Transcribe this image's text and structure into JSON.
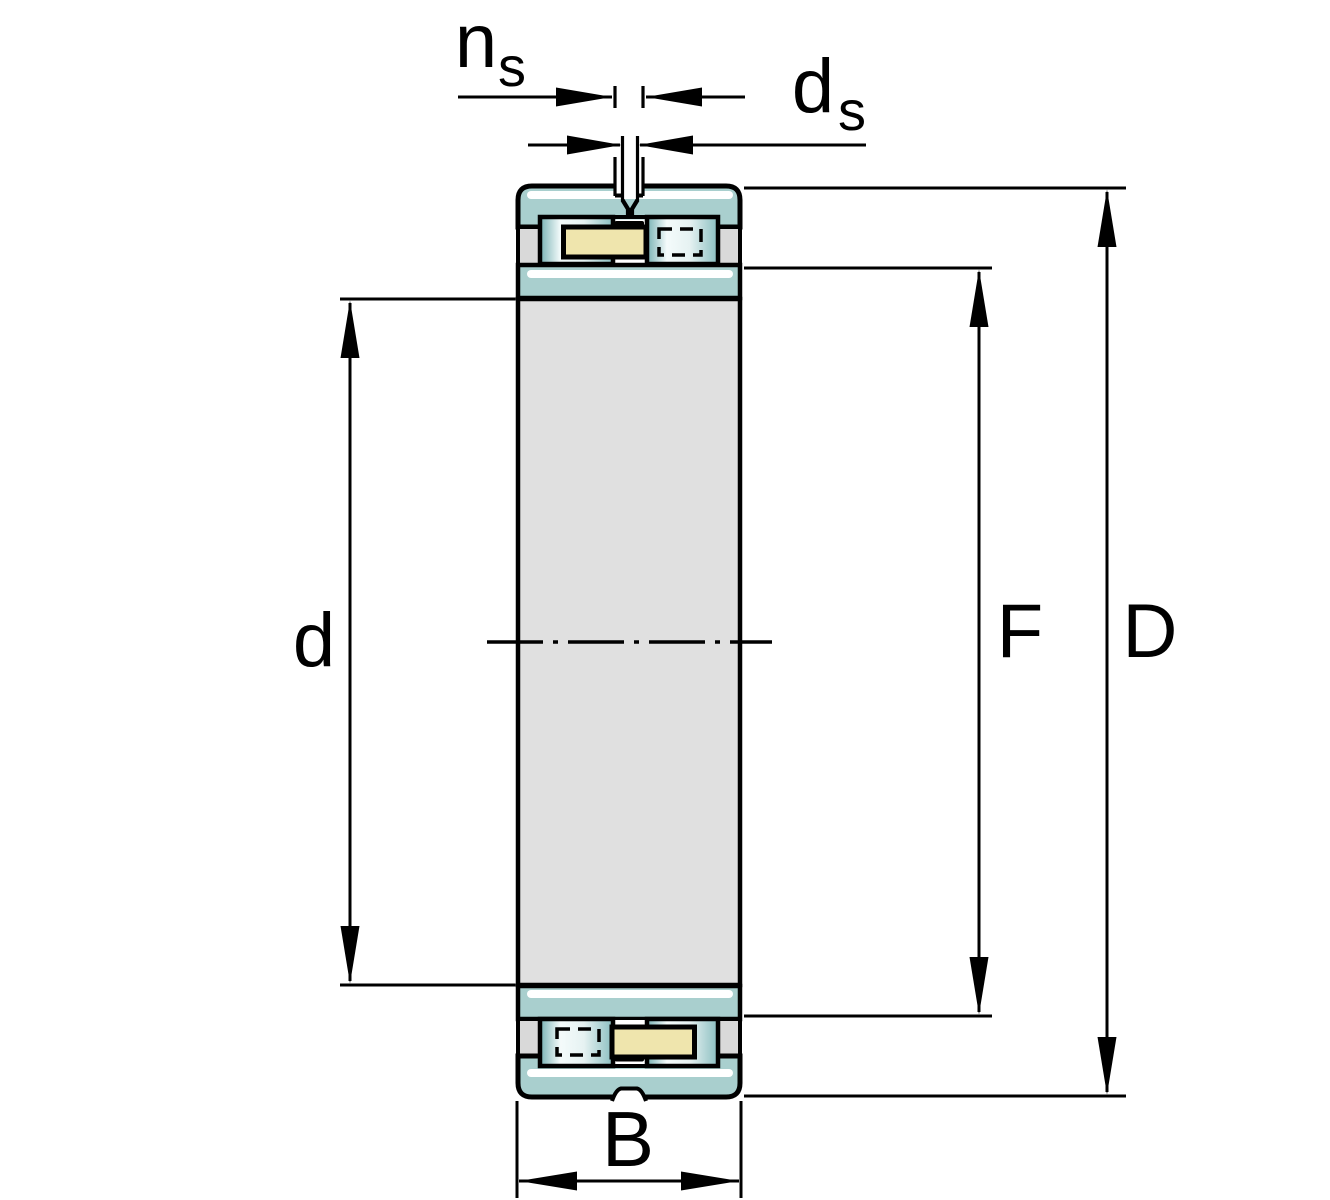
{
  "page": {
    "background": "#ffffff"
  },
  "colors": {
    "outline": "#000000",
    "ring_teal": "#a9cfce",
    "ring_highlight": "#ffffff",
    "land_gray": "#d9d9d9",
    "bore_gray": "#e0e0e0",
    "cage_yellow": "#efe5ad",
    "roller_dark": "#78b1b3",
    "roller_light": "#f4fbfb",
    "roller_pale": "#e6f2f2",
    "roller_edge": "#8abec0",
    "gap_white": "#ffffff",
    "background": "#ffffff"
  },
  "labels": {
    "groove_width": {
      "base": "n",
      "sub": "s"
    },
    "hole_diameter": {
      "base": "d",
      "sub": "s"
    },
    "bore_diameter": "d",
    "inner_raceway_diameter": "F",
    "outside_diameter": "D",
    "width": "B"
  }
}
